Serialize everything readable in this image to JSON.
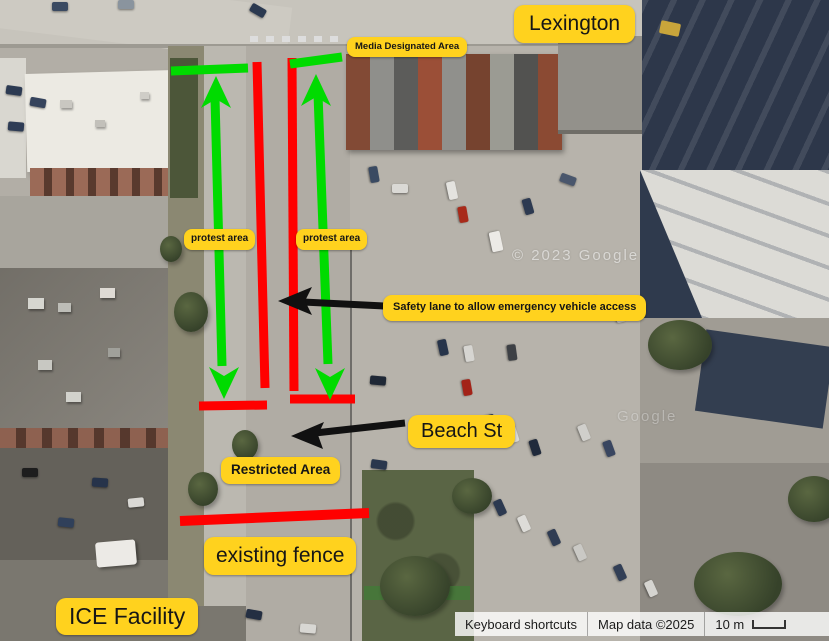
{
  "map": {
    "labels": {
      "lexington": "Lexington",
      "media_area": "Media Designated Area",
      "protest_left": "protest area",
      "protest_right": "protest area",
      "safety_lane": "Safety lane to allow emergency vehicle access",
      "beach_st": "Beach St",
      "restricted": "Restricted Area",
      "existing_fence": "existing fence",
      "ice_facility": "ICE Facility"
    },
    "watermarks": [
      "© 2023 Google",
      "Google"
    ],
    "annotation_colors": {
      "label_bg": "#FFD21E",
      "barrier_red": "#FF0000",
      "protest_green": "#00DB00",
      "arrow_black": "#111111"
    }
  },
  "attribution": {
    "keyboard_shortcuts": "Keyboard shortcuts",
    "map_data": "Map data ©2025",
    "scale_text": "10 m"
  }
}
